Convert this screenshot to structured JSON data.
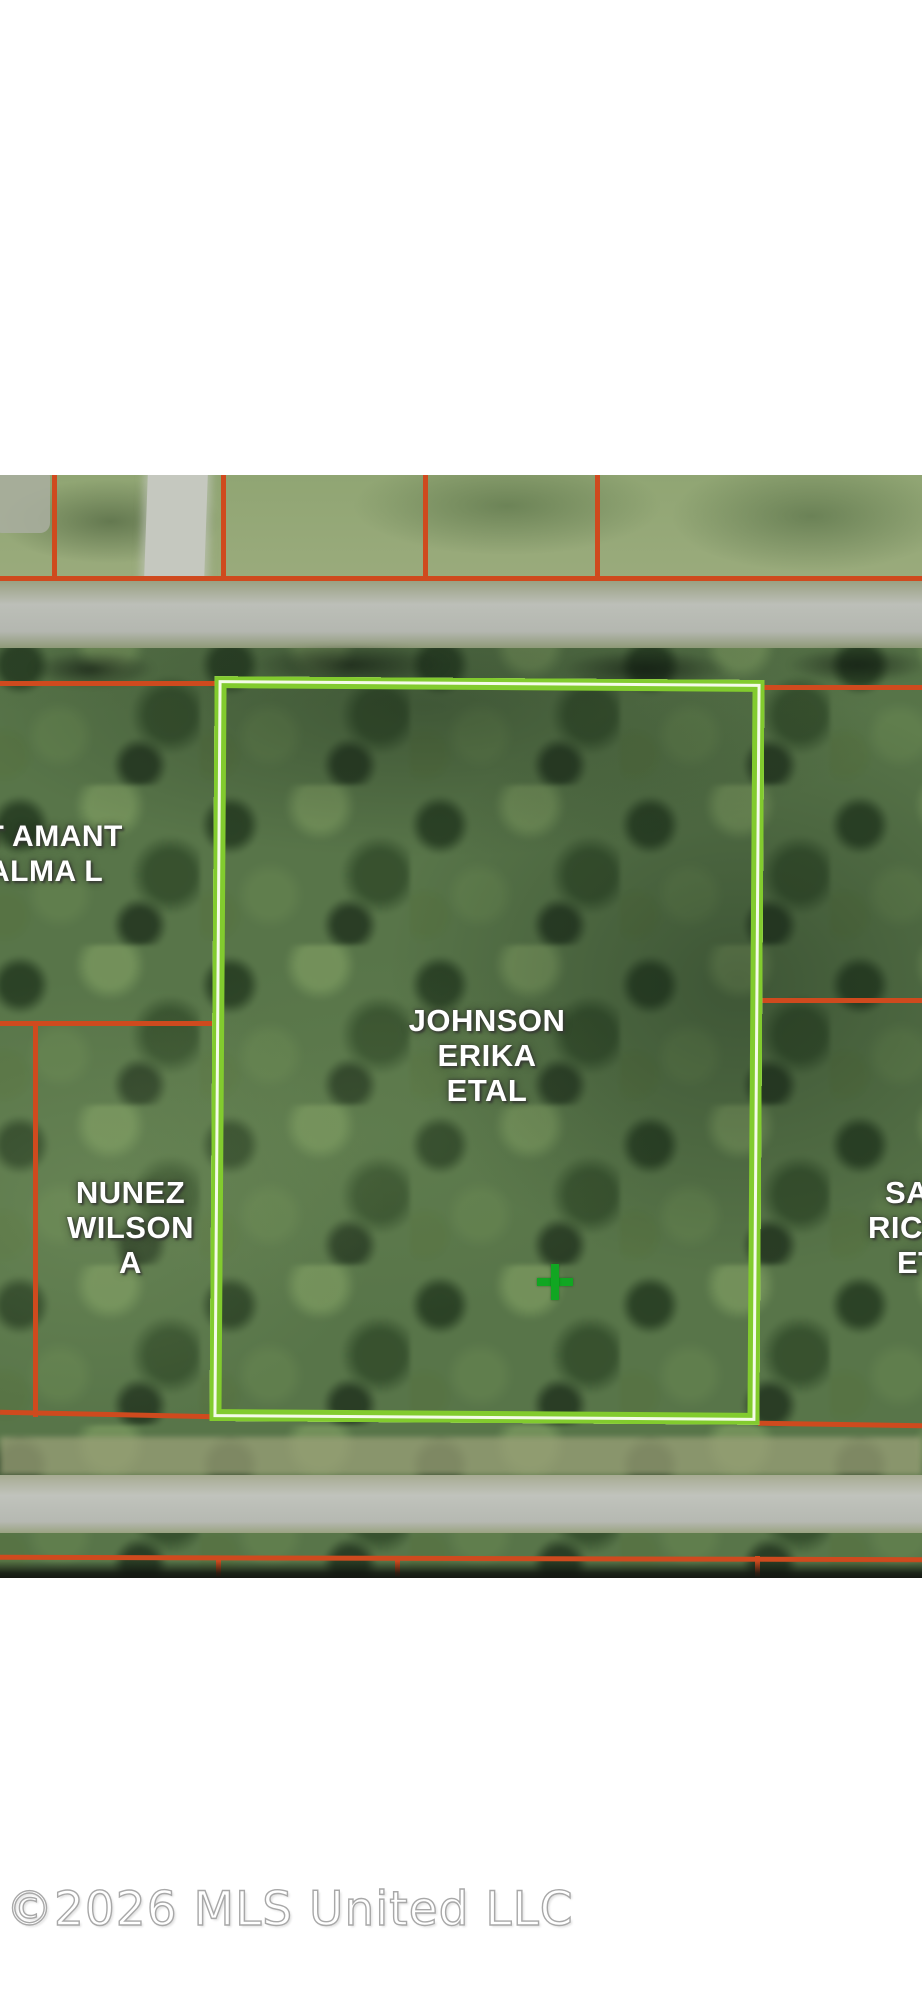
{
  "map": {
    "boundary_color": "#cf4a1e",
    "highlight_color": "#82cb2e",
    "marker_color": "#11a622",
    "parcels": {
      "highlighted": {
        "label_lines": [
          "JOHNSON",
          "ERIKA",
          "ETAL"
        ]
      },
      "left_upper": {
        "label_lines": [
          "ST AMANT",
          "ALMA L"
        ]
      },
      "left_lower": {
        "label_lines": [
          "NUNEZ",
          "WILSON",
          "A"
        ]
      },
      "right": {
        "label_lines": [
          "SA",
          "RIC",
          "ET"
        ]
      }
    }
  },
  "watermark": {
    "text": "©2026 MLS United LLC"
  }
}
